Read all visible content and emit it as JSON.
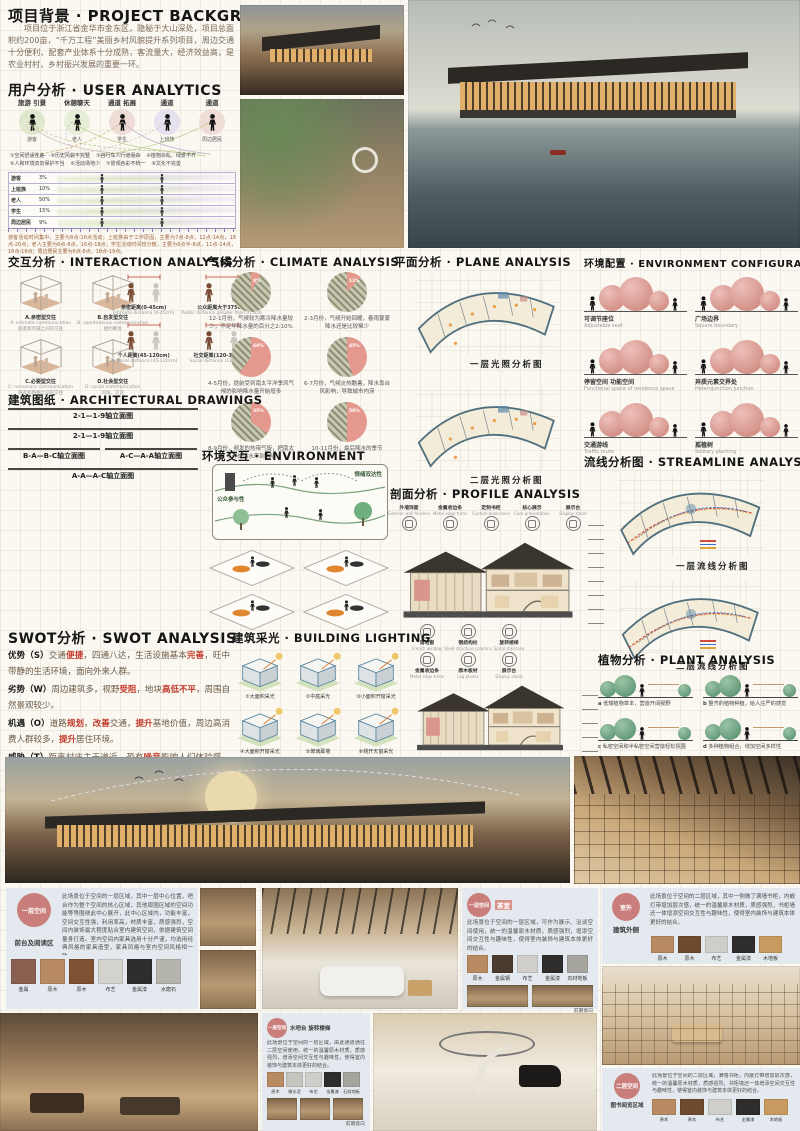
{
  "background": {
    "title": "项目背景 · PROJECT BACKGROUND",
    "body": "项目位于浙江省金华市金东区，隐秘于大山深处，项目总面积约200亩，“千万工程”美丽乡村风貌提升系列项目，周边交通十分便利，配套产业体系十分成熟，客流量大，经济效益高，是农业村村，乡村振兴发展的重要一环。"
  },
  "user": {
    "title": "用户分析 · USER ANALYTICS",
    "groups": [
      {
        "act": "旅游 引景",
        "name": "游客",
        "c": "#dfe8cc"
      },
      {
        "act": "休憩聊天",
        "name": "老人",
        "c": "#e7eed8"
      },
      {
        "act": "通道 拓展",
        "name": "学生",
        "c": "#f0dcd6"
      },
      {
        "act": "通道",
        "name": "上班族",
        "c": "#e6e1ef"
      },
      {
        "act": "通道",
        "name": "周边居民",
        "c": "#f0dcd6"
      }
    ],
    "issues": [
      "①空间舒适性差",
      "②历史风貌不完整",
      "③自行车人行道混杂",
      "④植物杂乱、绿景不齐",
      "⑤人和环境双向保护不当",
      "⑥活动场地少",
      "⑦景观色彩不统一",
      "⑧文化不完善"
    ],
    "table_rows": [
      {
        "label": "游客",
        "pct": "3%"
      },
      {
        "label": "上班族",
        "pct": "10%"
      },
      {
        "label": "老人",
        "pct": "50%"
      },
      {
        "label": "学生",
        "pct": "15%"
      },
      {
        "label": "周边居民",
        "pct": "9%"
      }
    ],
    "caption": "游客活动时间集中，主要为8点-18点活动；上班族由于工作原因，主要为7点-8点，12点-14点，18点-20点；老人主要为6点-8点，16点-18点；学生活动时间较分散，主要为6点半-8点，11点-14点，16点-18点；周边居民主要为6点-8点，18点-19点。"
  },
  "interaction": {
    "title": "交互分析 · INTERACTION ANALYSIS",
    "cubes": [
      {
        "zh": "A.亲密型交往",
        "en": "A: intimate communication",
        "sub": "朋友和亲属之间的交往"
      },
      {
        "zh": "B.自发型交往",
        "en": "B: spontaneous communication",
        "sub": "相约聚会"
      },
      {
        "zh": "C.必要型交往",
        "en": "C: necessary communication",
        "sub": "朋友和熟络之间的交往"
      },
      {
        "zh": "D.社会型交往",
        "en": "D: social communication",
        "sub": "问候、交谈"
      }
    ],
    "distances": [
      {
        "zh": "亲密距离(0-45cm)",
        "en": "Intimate distance (0-45cm)"
      },
      {
        "zh": "公众距离大于375cm",
        "en": "Public distance greater than 375cm"
      },
      {
        "zh": "个人距离(45-120cm)",
        "en": "Personal distance (45-120cm)"
      },
      {
        "zh": "社交距离(120-375cm)",
        "en": "Social distance (120-375cm)"
      }
    ]
  },
  "climate": {
    "title": "气候分析 · CLIMATE ANALYSIS",
    "pies": [
      {
        "p": "8%",
        "caption": "12-1月份，气候较为寒冷降水量较少，不足年降水量的百分之2:10%"
      },
      {
        "p": "12%",
        "caption": "2-3月份，气候开始回暖，春雨蒙蒙降水还是比较稀少"
      },
      {
        "p": "60%",
        "caption": "4-5月份，提前受到南太平洋季风气候的影响降水量开始增多"
      },
      {
        "p": "45%",
        "caption": "6-7月份，气候炎热酷暑，降水靠台风影响，导致城市内涝"
      },
      {
        "p": "35%",
        "caption": "8-9月份，频发的热带气旋，把南太平洋的海水带到内陆"
      },
      {
        "p": "50%",
        "caption": "10-11月份，最后降水的季节"
      }
    ]
  },
  "plane": {
    "title": "平面分析 · PLANE ANALYSIS",
    "labels": [
      "一层光照分析图",
      "二层光照分析图"
    ]
  },
  "envconf": {
    "title": "环境配置 · ENVIRONMENT CONFIGURATION",
    "items": [
      {
        "zh": "可调节座位",
        "en": "Adjustable seat"
      },
      {
        "zh": "广场边界",
        "en": "Square boundary"
      },
      {
        "zh": "停留空间 功能空间",
        "en": "Functional space of residence space"
      },
      {
        "zh": "异质元素交界处",
        "en": "Heterojunction junction"
      },
      {
        "zh": "交通游线",
        "en": "Traffic route"
      },
      {
        "zh": "孤植树",
        "en": "Solitary planting"
      }
    ]
  },
  "drawings": {
    "title": "建筑图纸 · ARCHITECTURAL DRAWINGS",
    "elevations": [
      {
        "label": "2-1—1-9轴立面图",
        "w": "190px",
        "h": "30px"
      },
      {
        "label": "2-1—1-9轴立面图",
        "w": "190px",
        "h": "32px"
      },
      {
        "label": "B-A—B-C轴立面图",
        "w": "92px",
        "h": "46px"
      },
      {
        "label": "A-C—A-A轴立面图",
        "w": "92px",
        "h": "46px"
      },
      {
        "label": "A-A—A-C轴立面图",
        "w": "190px",
        "h": "56px"
      }
    ]
  },
  "environment": {
    "title": "环境交互 · ENVIRONMENT",
    "tag_top": "情绪双达性",
    "tag_left": "公众参与性"
  },
  "profile": {
    "title": "剖面分析 · PROFILE ANALYSIS",
    "callouts_top": [
      {
        "zh": "外墙饰面",
        "en": "Exterior wall finishes"
      },
      {
        "zh": "金属收边条",
        "en": "Metal edge trims"
      },
      {
        "zh": "定制书柜",
        "en": "Custom bookcases"
      },
      {
        "zh": "核心展示",
        "en": "Core presentation"
      },
      {
        "zh": "展示台",
        "en": "Display stand"
      }
    ],
    "callouts_mid": [
      {
        "zh": "落地窗",
        "en": "French window"
      },
      {
        "zh": "钢结构柱",
        "en": "Steel structure columns"
      },
      {
        "zh": "旋转楼梯",
        "en": "Spiral staircase"
      }
    ],
    "callouts_mid2": [
      {
        "zh": "金属收边条",
        "en": "Metal edge trims"
      },
      {
        "zh": "原木板材",
        "en": "Log planks"
      },
      {
        "zh": "展示台",
        "en": "Display stand"
      }
    ]
  },
  "streamline": {
    "title": "流线分析图 · STREAMLINE ANALYSIS",
    "labels": [
      "一层流线分析图",
      "二层流线分析图"
    ]
  },
  "swot": {
    "title": "SWOT分析 · SWOT ANALYSIS",
    "items": [
      {
        "label": "优势（S）",
        "body": "交通¤便捷¤，四通八达，生活设施基本¤完善¤，旺中带静的生活环境，面向外来人群。"
      },
      {
        "label": "劣势（W）",
        "body": "周边建筑多，视野¤受阻¤，地块¤高低不平¤，周围自然景观较少。"
      },
      {
        "label": "机遇（O）",
        "body": "道路¤规划¤，¤改善¤交通，¤提升¤基地价值，周边高消费人群较多，¤提升¤居住环境。"
      },
      {
        "label": "威胁（T）",
        "body": "距离村庄主干道近，恐有¤噪音¤影响人们体验感，地势高差恐对人有¤安全隐患¤。"
      }
    ]
  },
  "lighting": {
    "title": "建筑采光 · BUILDING LIGHTING",
    "items": [
      "①大面积采光",
      "②中庭采光",
      "③小面积开窗采光",
      "④大面积开窗采光",
      "⑤玻璃幕墙",
      "⑥侧开天窗采光"
    ]
  },
  "plants": {
    "title": "植物分析 · PLANT ANALYSIS",
    "items": [
      {
        "k": "a",
        "text": "低矮植物草本，营造开阔视野"
      },
      {
        "k": "b",
        "text": "整齐的植物种植，给人庄严的感觉"
      },
      {
        "k": "c",
        "text": "私密空间和半私密空间营造轻松氛围"
      },
      {
        "k": "d",
        "text": "多种植物组合，增加空间多样性"
      }
    ]
  },
  "interiors": {
    "reception": {
      "tag": "一层空间",
      "zone": "前台及阅读区",
      "text": "此场景位于空间的一层区域，其中一层中心位置，吧台作为整个空间的核心区域，其他周围区域的空间功能等等围绕此中心展开，此中心区域内，功能丰富，空间交互性强，利用率高，材质丰富，质感强烈，空间内装饰最大程度贴合室内建筑空间，依据建筑空间量身打造。室内空间内家具选用十分严谨，均选用经典风格的家具造型，家具风格与室内空间风格相一致。",
      "materials": [
        {
          "n": "金属",
          "c": "#8a6050"
        },
        {
          "n": "原木",
          "c": "#b98b62"
        },
        {
          "n": "原木",
          "c": "#7d5233"
        },
        {
          "n": "布艺",
          "c": "#d3d2cd"
        },
        {
          "n": "金属漆",
          "c": "#2e2d2b"
        },
        {
          "n": "水磨石",
          "c": "#b6b5ad"
        }
      ]
    },
    "tea": {
      "tag": "一层空间",
      "zone": "茶室",
      "text": "此场景位于空间的一层区域，可作为展示、洽谈空间使用，统一的温馨原木材质，质感强烈，增添空间交互性与趣味性，使得室内装饰与建筑本体更好的结合。",
      "materials": [
        {
          "n": "原木",
          "c": "#b98b62"
        },
        {
          "n": "金属钢",
          "c": "#4c3a2e"
        },
        {
          "n": "布艺",
          "c": "#cfcecb"
        },
        {
          "n": "金属漆",
          "c": "#2e2d2b"
        },
        {
          "n": "石材地板",
          "c": "#a5a49d"
        }
      ],
      "ref_label": "前期意向"
    },
    "exterior": {
      "tag": "室外",
      "zone": "建筑外侧",
      "text": "此场景位于空间的二层区域，其中一侧做了满墙书柜，内嵌灯带增加层次感，统一的温馨原木材质，质感强烈，书柜墙还一体增添空间交互性与趣味性，使得室内装饰与建筑本体更好的结合。",
      "materials": [
        {
          "n": "原木",
          "c": "#b98b62"
        },
        {
          "n": "原木",
          "c": "#6f4a2f"
        },
        {
          "n": "布艺",
          "c": "#cfcecb"
        },
        {
          "n": "金属漆",
          "c": "#2e2d2b"
        },
        {
          "n": "木地板",
          "c": "#c99a5f"
        }
      ]
    },
    "waterbar": {
      "tag": "一层空间",
      "zone": "水吧台 旋转楼梯",
      "text": "此场景位于空间的一层区域，由此通道通往二层空间使用，统一的温馨原木材质，质感强烈，增添空间交互性与趣味性，使得室内装饰与建筑本体更好的结合。",
      "materials": [
        {
          "n": "原木",
          "c": "#b98b62"
        },
        {
          "n": "微水泥",
          "c": "#c6c5c0"
        },
        {
          "n": "布艺",
          "c": "#cfcecb"
        },
        {
          "n": "金属漆",
          "c": "#2e2d2b"
        },
        {
          "n": "石材地板",
          "c": "#a5a49d"
        }
      ],
      "ref_label": "前期意向"
    },
    "library": {
      "tag": "二层空间",
      "zone": "图书阅览区域",
      "text": "此场景位于空间的二层区域，满墙书柜，内嵌灯带增加层次感，统一的温馨原木材质，质感强烈，书柜墙还一体增添空间交互性与趣味性，使得室内装饰与建筑本体更好的结合。",
      "materials": [
        {
          "n": "原木",
          "c": "#b98b62"
        },
        {
          "n": "原木",
          "c": "#6f4a2f"
        },
        {
          "n": "布艺",
          "c": "#cfcecb"
        },
        {
          "n": "金属漆",
          "c": "#2e2d2b"
        },
        {
          "n": "木地板",
          "c": "#c99a5f"
        }
      ]
    }
  },
  "colors": {
    "accent_red": "#c23a2b",
    "pie_pink": "#e5988d",
    "panel_blue": "#e3e9ee",
    "circle_pink": "#ca7e7b"
  }
}
